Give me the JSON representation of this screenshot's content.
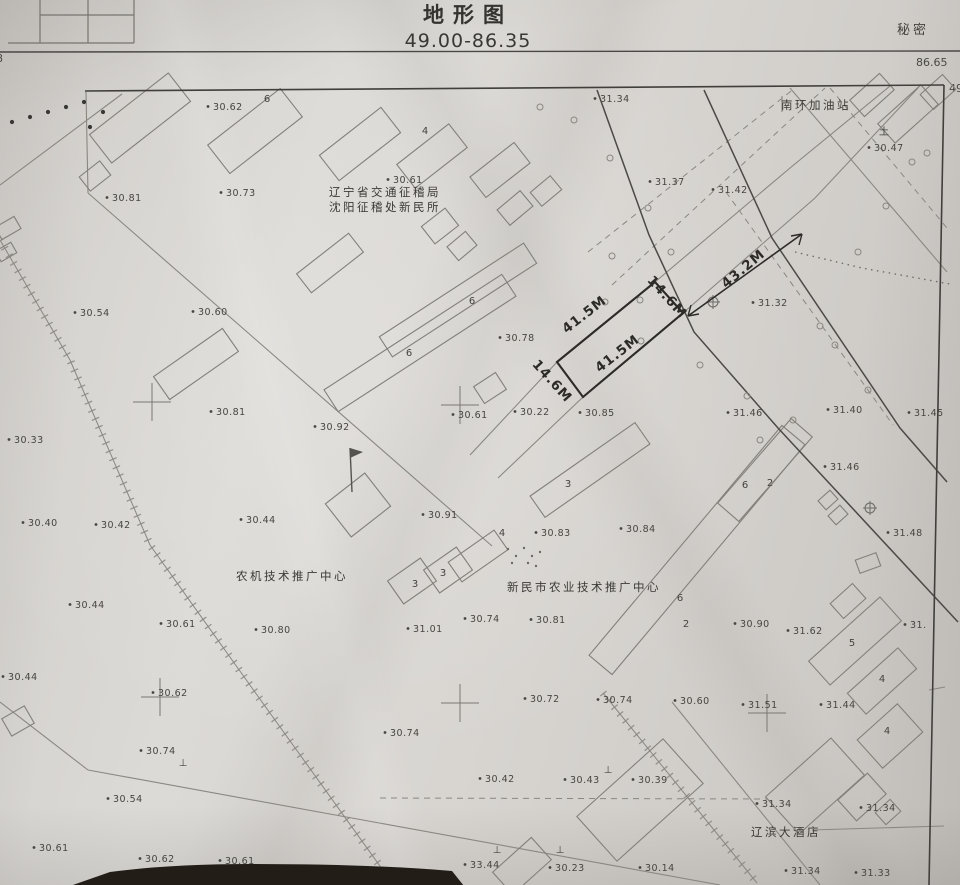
{
  "header": {
    "title": "地形图",
    "sheet_range": "49.00-86.35",
    "classification": "秘密",
    "corner_value_right_top": "86.65",
    "corner_value_right_edge": "49",
    "corner_value_left_edge": "8"
  },
  "map": {
    "place_labels": [
      {
        "t": "南环加油站",
        "x": 816,
        "y": 109
      },
      {
        "t": "辽宁省交通征稽局",
        "x": 385,
        "y": 196
      },
      {
        "t": "沈阳征稽处新民所",
        "x": 385,
        "y": 211
      },
      {
        "t": "农机技术推广中心",
        "x": 292,
        "y": 580
      },
      {
        "t": "新民市农业技术推广中心",
        "x": 584,
        "y": 591
      },
      {
        "t": "辽滨大酒店",
        "x": 786,
        "y": 836
      }
    ],
    "spot_elevations": [
      {
        "v": "31.34",
        "x": 600,
        "y": 102
      },
      {
        "v": "30.62",
        "x": 213,
        "y": 110
      },
      {
        "v": "30.47",
        "x": 874,
        "y": 151
      },
      {
        "v": "30.81",
        "x": 112,
        "y": 201
      },
      {
        "v": "30.73",
        "x": 226,
        "y": 196
      },
      {
        "v": "30.61",
        "x": 393,
        "y": 183
      },
      {
        "v": "31.37",
        "x": 655,
        "y": 185
      },
      {
        "v": "31.42",
        "x": 718,
        "y": 193
      },
      {
        "v": "30.54",
        "x": 80,
        "y": 316
      },
      {
        "v": "30.60",
        "x": 198,
        "y": 315
      },
      {
        "v": "31.32",
        "x": 758,
        "y": 306
      },
      {
        "v": "30.78",
        "x": 505,
        "y": 341
      },
      {
        "v": "30.81",
        "x": 216,
        "y": 415
      },
      {
        "v": "30.92",
        "x": 320,
        "y": 430
      },
      {
        "v": "30.61",
        "x": 458,
        "y": 418
      },
      {
        "v": "30.22",
        "x": 520,
        "y": 415
      },
      {
        "v": "30.85",
        "x": 585,
        "y": 416
      },
      {
        "v": "31.46",
        "x": 733,
        "y": 416
      },
      {
        "v": "31.40",
        "x": 833,
        "y": 413
      },
      {
        "v": "31.45",
        "x": 914,
        "y": 416
      },
      {
        "v": "30.33",
        "x": 14,
        "y": 443
      },
      {
        "v": "31.46",
        "x": 830,
        "y": 470
      },
      {
        "v": "30.40",
        "x": 28,
        "y": 526
      },
      {
        "v": "30.42",
        "x": 101,
        "y": 528
      },
      {
        "v": "30.44",
        "x": 246,
        "y": 523
      },
      {
        "v": "30.91",
        "x": 428,
        "y": 518
      },
      {
        "v": "31.48",
        "x": 893,
        "y": 536
      },
      {
        "v": "30.83",
        "x": 541,
        "y": 536
      },
      {
        "v": "30.84",
        "x": 626,
        "y": 532
      },
      {
        "v": "30.44",
        "x": 75,
        "y": 608
      },
      {
        "v": "30.61",
        "x": 166,
        "y": 627
      },
      {
        "v": "30.80",
        "x": 261,
        "y": 633
      },
      {
        "v": "31.01",
        "x": 413,
        "y": 632
      },
      {
        "v": "30.74",
        "x": 470,
        "y": 622
      },
      {
        "v": "30.81",
        "x": 536,
        "y": 623
      },
      {
        "v": "30.90",
        "x": 740,
        "y": 627
      },
      {
        "v": "31.62",
        "x": 793,
        "y": 634
      },
      {
        "v": "31.",
        "x": 910,
        "y": 628
      },
      {
        "v": "30.44",
        "x": 8,
        "y": 680
      },
      {
        "v": "30.62",
        "x": 158,
        "y": 696
      },
      {
        "v": "30.60",
        "x": 680,
        "y": 704
      },
      {
        "v": "30.74",
        "x": 603,
        "y": 703
      },
      {
        "v": "31.51",
        "x": 748,
        "y": 708
      },
      {
        "v": "31.44",
        "x": 826,
        "y": 708
      },
      {
        "v": "30.72",
        "x": 530,
        "y": 702
      },
      {
        "v": "30.74",
        "x": 390,
        "y": 736
      },
      {
        "v": "30.74",
        "x": 146,
        "y": 754
      },
      {
        "v": "30.42",
        "x": 485,
        "y": 782
      },
      {
        "v": "30.43",
        "x": 570,
        "y": 783
      },
      {
        "v": "30.39",
        "x": 638,
        "y": 783
      },
      {
        "v": "30.54",
        "x": 113,
        "y": 802
      },
      {
        "v": "31.34",
        "x": 762,
        "y": 807
      },
      {
        "v": "31.34",
        "x": 866,
        "y": 811
      },
      {
        "v": "30.61",
        "x": 39,
        "y": 851
      },
      {
        "v": "30.62",
        "x": 145,
        "y": 862
      },
      {
        "v": "30.61",
        "x": 225,
        "y": 864
      },
      {
        "v": "30.64",
        "x": 323,
        "y": 876
      },
      {
        "v": "33.44",
        "x": 470,
        "y": 868
      },
      {
        "v": "30.23",
        "x": 555,
        "y": 871
      },
      {
        "v": "30.14",
        "x": 645,
        "y": 871
      },
      {
        "v": "31.34",
        "x": 791,
        "y": 874
      },
      {
        "v": "31.33",
        "x": 861,
        "y": 876
      }
    ],
    "floor_labels": [
      {
        "v": "6",
        "x": 267,
        "y": 102
      },
      {
        "v": "4",
        "x": 425,
        "y": 134
      },
      {
        "v": "6",
        "x": 472,
        "y": 304
      },
      {
        "v": "6",
        "x": 409,
        "y": 356
      },
      {
        "v": "3",
        "x": 568,
        "y": 487
      },
      {
        "v": "4",
        "x": 502,
        "y": 536
      },
      {
        "v": "3",
        "x": 443,
        "y": 576
      },
      {
        "v": "3",
        "x": 415,
        "y": 587
      },
      {
        "v": "6",
        "x": 745,
        "y": 488
      },
      {
        "v": "2",
        "x": 770,
        "y": 486
      },
      {
        "v": "6",
        "x": 680,
        "y": 601
      },
      {
        "v": "2",
        "x": 686,
        "y": 627
      },
      {
        "v": "5",
        "x": 852,
        "y": 646
      },
      {
        "v": "4",
        "x": 882,
        "y": 682
      },
      {
        "v": "4",
        "x": 887,
        "y": 734
      }
    ],
    "dimension_notes": [
      {
        "t": "41.5M",
        "x": 587,
        "y": 318,
        "r": -38
      },
      {
        "t": "41.5M",
        "x": 620,
        "y": 357,
        "r": -38
      },
      {
        "t": "14.6M",
        "x": 664,
        "y": 300,
        "r": 48
      },
      {
        "t": "14.6M",
        "x": 549,
        "y": 384,
        "r": 48
      },
      {
        "t": "43.2M",
        "x": 746,
        "y": 272,
        "r": -40
      }
    ],
    "survey_symbols": [
      {
        "t": "土",
        "x": 884,
        "y": 135
      },
      {
        "t": "⊥",
        "x": 183,
        "y": 766
      },
      {
        "t": "⊥",
        "x": 608,
        "y": 773
      },
      {
        "t": "⊥",
        "x": 497,
        "y": 853
      },
      {
        "t": "⊥",
        "x": 560,
        "y": 853
      }
    ],
    "parcel_sketch": {
      "points": "557,362 655,282 683,313 583,397"
    },
    "dim_arrow": {
      "x1": 688,
      "y1": 316,
      "x2": 802,
      "y2": 234
    },
    "buildings": [
      [
        140,
        118,
        100,
        36,
        -38
      ],
      [
        255,
        131,
        92,
        36,
        -38
      ],
      [
        360,
        144,
        78,
        32,
        -38
      ],
      [
        432,
        156,
        66,
        30,
        -38
      ],
      [
        500,
        170,
        56,
        26,
        -38
      ],
      [
        95,
        176,
        26,
        18,
        -38
      ],
      [
        8,
        228,
        22,
        14,
        -30
      ],
      [
        6,
        252,
        18,
        12,
        -30
      ],
      [
        330,
        263,
        66,
        24,
        -38
      ],
      [
        440,
        226,
        30,
        22,
        -38
      ],
      [
        462,
        246,
        24,
        18,
        -40
      ],
      [
        515,
        208,
        30,
        20,
        -40
      ],
      [
        546,
        191,
        26,
        18,
        -40
      ],
      [
        196,
        364,
        84,
        28,
        -35
      ],
      [
        420,
        343,
        212,
        26,
        -33
      ],
      [
        458,
        300,
        172,
        24,
        -33
      ],
      [
        490,
        388,
        26,
        20,
        -33
      ],
      [
        358,
        505,
        50,
        42,
        -38
      ],
      [
        412,
        581,
        40,
        28,
        -35
      ],
      [
        448,
        570,
        40,
        28,
        -35
      ],
      [
        590,
        470,
        128,
        26,
        -35
      ],
      [
        478,
        556,
        56,
        24,
        -35
      ],
      [
        697,
        550,
        300,
        30,
        -50
      ],
      [
        765,
        470,
        112,
        28,
        -49
      ],
      [
        855,
        641,
        96,
        32,
        -42
      ],
      [
        882,
        681,
        68,
        28,
        -42
      ],
      [
        890,
        736,
        54,
        38,
        -42
      ],
      [
        848,
        601,
        30,
        20,
        -42
      ],
      [
        908,
        114,
        58,
        26,
        -42
      ],
      [
        938,
        92,
        30,
        20,
        -42
      ],
      [
        828,
        500,
        16,
        12,
        -42
      ],
      [
        838,
        515,
        16,
        12,
        -42
      ],
      [
        640,
        800,
        116,
        60,
        -42
      ],
      [
        815,
        786,
        88,
        50,
        -42
      ],
      [
        862,
        797,
        40,
        28,
        -42
      ],
      [
        888,
        812,
        20,
        16,
        -42
      ],
      [
        522,
        866,
        52,
        30,
        -42
      ],
      [
        18,
        721,
        26,
        20,
        -30
      ],
      [
        868,
        563,
        22,
        14,
        -20
      ],
      [
        872,
        95,
        40,
        22,
        -42
      ]
    ],
    "roads_dark": [
      [
        [
          597,
          90
        ],
        [
          649,
          235
        ],
        [
          694,
          332
        ],
        [
          778,
          428
        ],
        [
          958,
          622
        ]
      ],
      [
        [
          704,
          90
        ],
        [
          772,
          238
        ],
        [
          900,
          428
        ],
        [
          947,
          482
        ]
      ]
    ],
    "neatline": [
      [
        [
          85,
          91
        ],
        [
          944,
          85
        ]
      ],
      [
        [
          944,
          85
        ],
        [
          929,
          885
        ]
      ]
    ],
    "roads_light": [
      [
        [
          470,
          455
        ],
        [
          557,
          362
        ],
        [
          655,
          282
        ],
        [
          790,
          168
        ],
        [
          890,
          86
        ]
      ],
      [
        [
          498,
          478
        ],
        [
          583,
          397
        ],
        [
          683,
          313
        ],
        [
          815,
          198
        ],
        [
          918,
          88
        ]
      ],
      [
        [
          0,
          185
        ],
        [
          122,
          94
        ]
      ],
      [
        [
          88,
          193
        ],
        [
          492,
          546
        ]
      ],
      [
        [
          86,
          92
        ],
        [
          88,
          193
        ]
      ],
      [
        [
          0,
          702
        ],
        [
          88,
          770
        ]
      ],
      [
        [
          88,
          770
        ],
        [
          720,
          885
        ]
      ],
      [
        [
          790,
          88
        ],
        [
          947,
          272
        ]
      ],
      [
        [
          812,
          830
        ],
        [
          944,
          826
        ]
      ],
      [
        [
          672,
          702
        ],
        [
          820,
          885
        ]
      ],
      [
        [
          929,
          690
        ],
        [
          945,
          687
        ]
      ],
      [
        [
          782,
          96
        ],
        [
          782,
          112
        ]
      ]
    ],
    "roads_dashed": [
      [
        [
          588,
          252
        ],
        [
          795,
          88
        ]
      ],
      [
        [
          612,
          285
        ],
        [
          825,
          88
        ]
      ],
      [
        [
          726,
          192
        ],
        [
          893,
          425
        ]
      ],
      [
        [
          830,
          88
        ],
        [
          947,
          228
        ]
      ],
      [
        [
          380,
          798
        ],
        [
          768,
          799
        ]
      ]
    ],
    "dotted_paths": [
      [
        [
          795,
          252
        ],
        [
          862,
          268
        ],
        [
          950,
          284
        ]
      ]
    ],
    "fences": [
      [
        [
          0,
          240
        ],
        [
          70,
          360
        ],
        [
          150,
          545
        ],
        [
          257,
          695
        ],
        [
          390,
          880
        ]
      ],
      [
        [
          603,
          693
        ],
        [
          757,
          883
        ]
      ]
    ],
    "grid_crosses": [
      [
        152,
        402
      ],
      [
        460,
        405
      ],
      [
        160,
        697
      ],
      [
        460,
        703
      ],
      [
        767,
        713
      ]
    ],
    "pole_circles": [
      [
        540,
        107
      ],
      [
        574,
        120
      ],
      [
        610,
        158
      ],
      [
        648,
        208
      ],
      [
        612,
        256
      ],
      [
        640,
        300
      ],
      [
        700,
        365
      ],
      [
        747,
        396
      ],
      [
        760,
        440
      ],
      [
        793,
        420
      ],
      [
        820,
        326
      ],
      [
        858,
        252
      ],
      [
        886,
        206
      ],
      [
        912,
        162
      ],
      [
        641,
        341
      ],
      [
        605,
        302
      ],
      [
        671,
        252
      ],
      [
        927,
        153
      ],
      [
        835,
        345
      ],
      [
        868,
        390
      ]
    ],
    "oplus_marks": [
      [
        713,
        302
      ],
      [
        870,
        508
      ]
    ],
    "black_dots": [
      [
        103,
        112
      ],
      [
        90,
        127
      ],
      [
        12,
        122
      ],
      [
        30,
        117
      ],
      [
        48,
        112
      ],
      [
        66,
        107
      ],
      [
        84,
        102
      ]
    ],
    "courtyard_dots": [
      [
        508,
        549
      ],
      [
        516,
        556
      ],
      [
        524,
        548
      ],
      [
        532,
        556
      ],
      [
        512,
        563
      ],
      [
        528,
        563
      ],
      [
        540,
        552
      ],
      [
        536,
        566
      ]
    ],
    "flag_symbol": {
      "x": 352,
      "y": 492,
      "h": 44
    }
  }
}
